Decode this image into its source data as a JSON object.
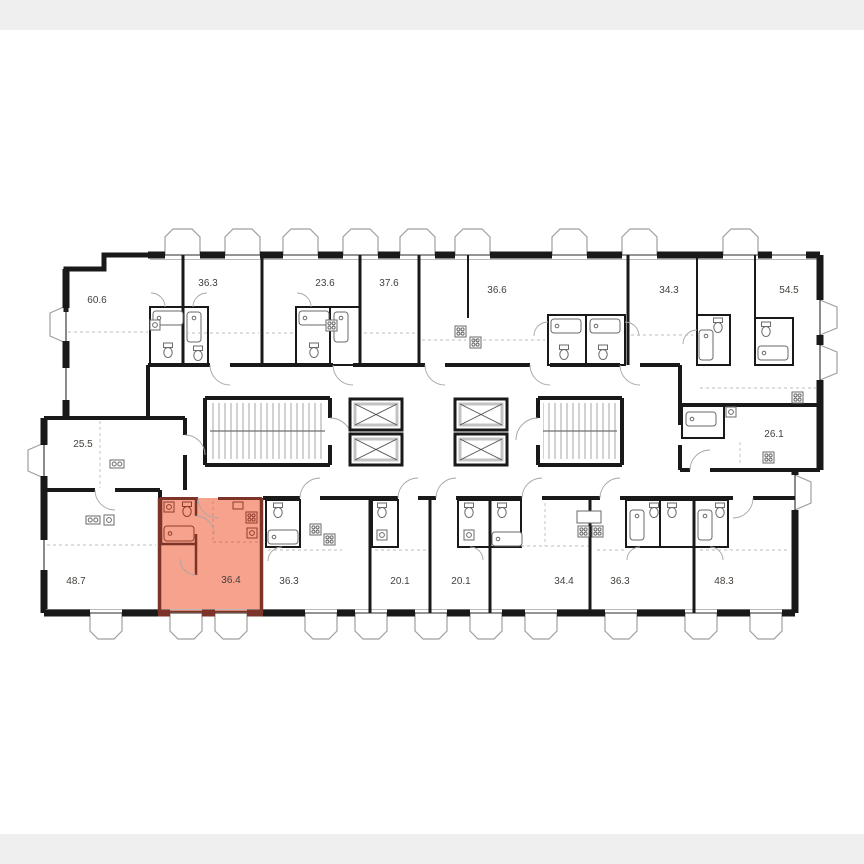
{
  "canvas": {
    "page_bg": "#efefef",
    "photo_bg": "#ffffff",
    "wall_color": "#191919",
    "line_gray": "#9f9f9f"
  },
  "highlight": {
    "fill": "#f6a28d",
    "wall_color": "#7c3429",
    "area": "36.4"
  },
  "apartments": [
    {
      "area": "60.6",
      "row": "top",
      "highlighted": false
    },
    {
      "area": "36.3",
      "row": "top",
      "highlighted": false
    },
    {
      "area": "23.6",
      "row": "top",
      "highlighted": false
    },
    {
      "area": "37.6",
      "row": "top",
      "highlighted": false
    },
    {
      "area": "36.6",
      "row": "top",
      "highlighted": false
    },
    {
      "area": "34.3",
      "row": "top",
      "highlighted": false
    },
    {
      "area": "54.5",
      "row": "top",
      "highlighted": false
    },
    {
      "area": "25.5",
      "row": "middle-left",
      "highlighted": false
    },
    {
      "area": "26.1",
      "row": "middle-right",
      "highlighted": false
    },
    {
      "area": "48.7",
      "row": "bottom",
      "highlighted": false
    },
    {
      "area": "36.4",
      "row": "bottom",
      "highlighted": true
    },
    {
      "area": "36.3",
      "row": "bottom",
      "highlighted": false
    },
    {
      "area": "20.1",
      "row": "bottom",
      "highlighted": false
    },
    {
      "area": "20.1",
      "row": "bottom",
      "highlighted": false
    },
    {
      "area": "34.4",
      "row": "bottom",
      "highlighted": false
    },
    {
      "area": "36.3",
      "row": "bottom",
      "highlighted": false
    },
    {
      "area": "48.3",
      "row": "bottom",
      "highlighted": false
    }
  ]
}
